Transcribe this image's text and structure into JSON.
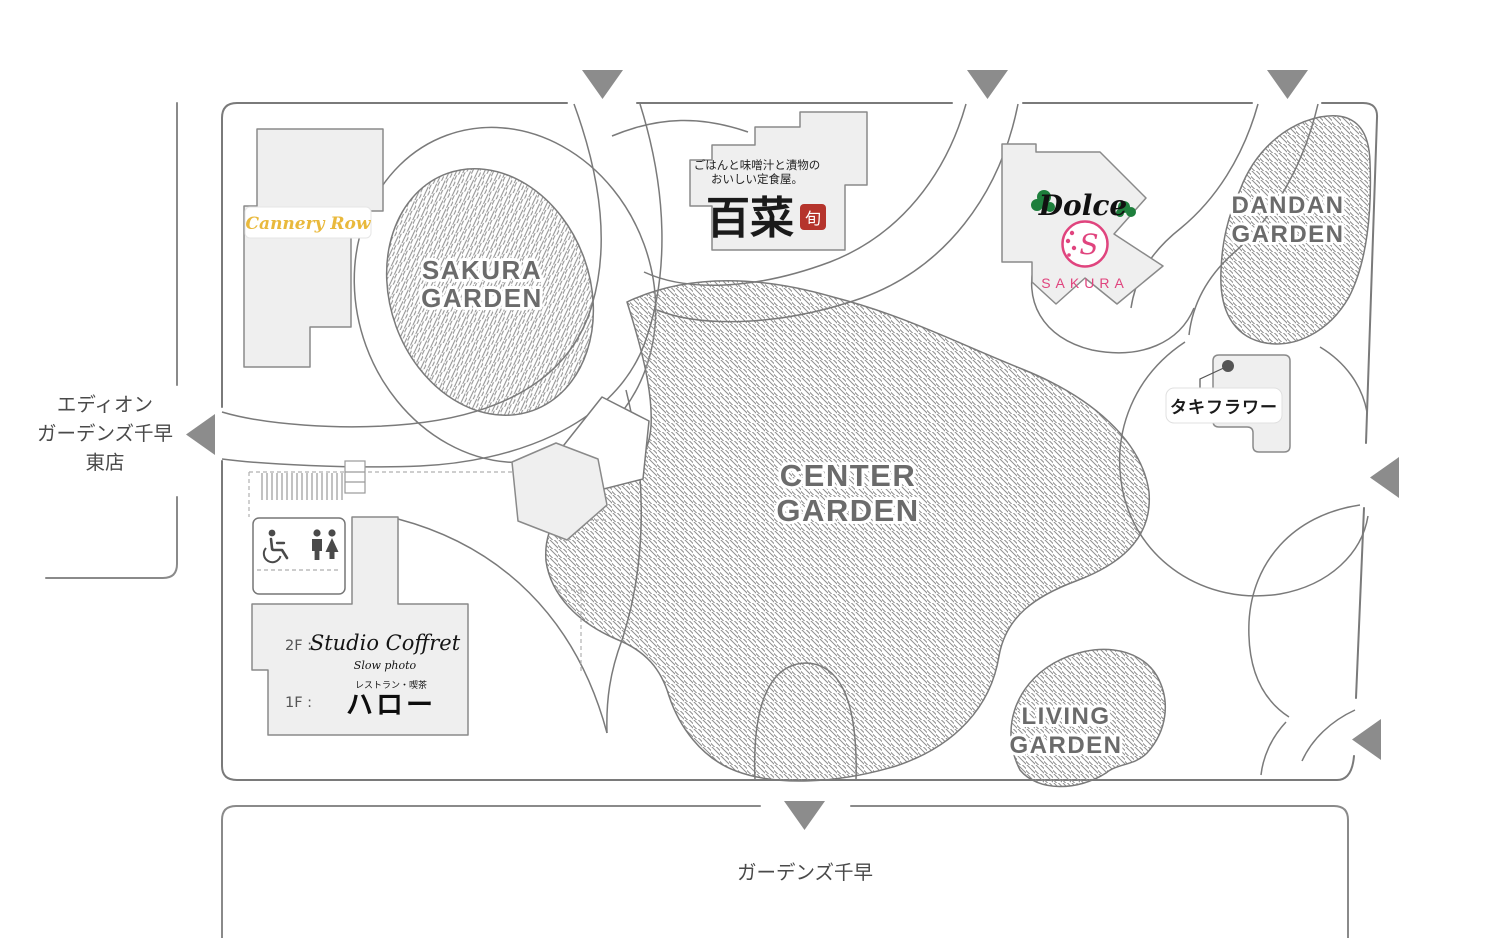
{
  "colors": {
    "arrow": "#8c8c8c",
    "cannery_yellow": "#e9b93c",
    "dolce_green": "#1e7f3c",
    "sakura_pink": "#e0447e",
    "seal_red": "#b5342c"
  },
  "outside": {
    "west_label": {
      "line1": "エディオン",
      "line2": "ガーデンズ千早",
      "line3": "東店"
    },
    "south_label": "ガーデンズ千早"
  },
  "gardens": {
    "sakura": {
      "line1": "SAKURA",
      "line2": "GARDEN"
    },
    "center": {
      "line1": "CENTER",
      "line2": "GARDEN"
    },
    "dandan": {
      "line1": "DANDAN",
      "line2": "GARDEN"
    },
    "living": {
      "line1": "LIVING",
      "line2": "GARDEN"
    }
  },
  "stores": {
    "cannery_row": {
      "name": "Cannery Row"
    },
    "hyakusai": {
      "tagline1": "ごはんと味噌汁と漬物の",
      "tagline2": "おいしい定食屋。",
      "name": "百菜",
      "seal": "旬"
    },
    "dolce": {
      "name": "Dolce"
    },
    "sakura_shop": {
      "name": "SAKURA",
      "monogram": "S"
    },
    "taki_flower": {
      "name": "タキフラワー"
    },
    "studio_coffret": {
      "floor": "2F :",
      "name": "Studio Coffret",
      "sub": "Slow photo"
    },
    "hello": {
      "floor": "1F :",
      "sub": "レストラン・喫茶",
      "name": "ハロー"
    }
  }
}
